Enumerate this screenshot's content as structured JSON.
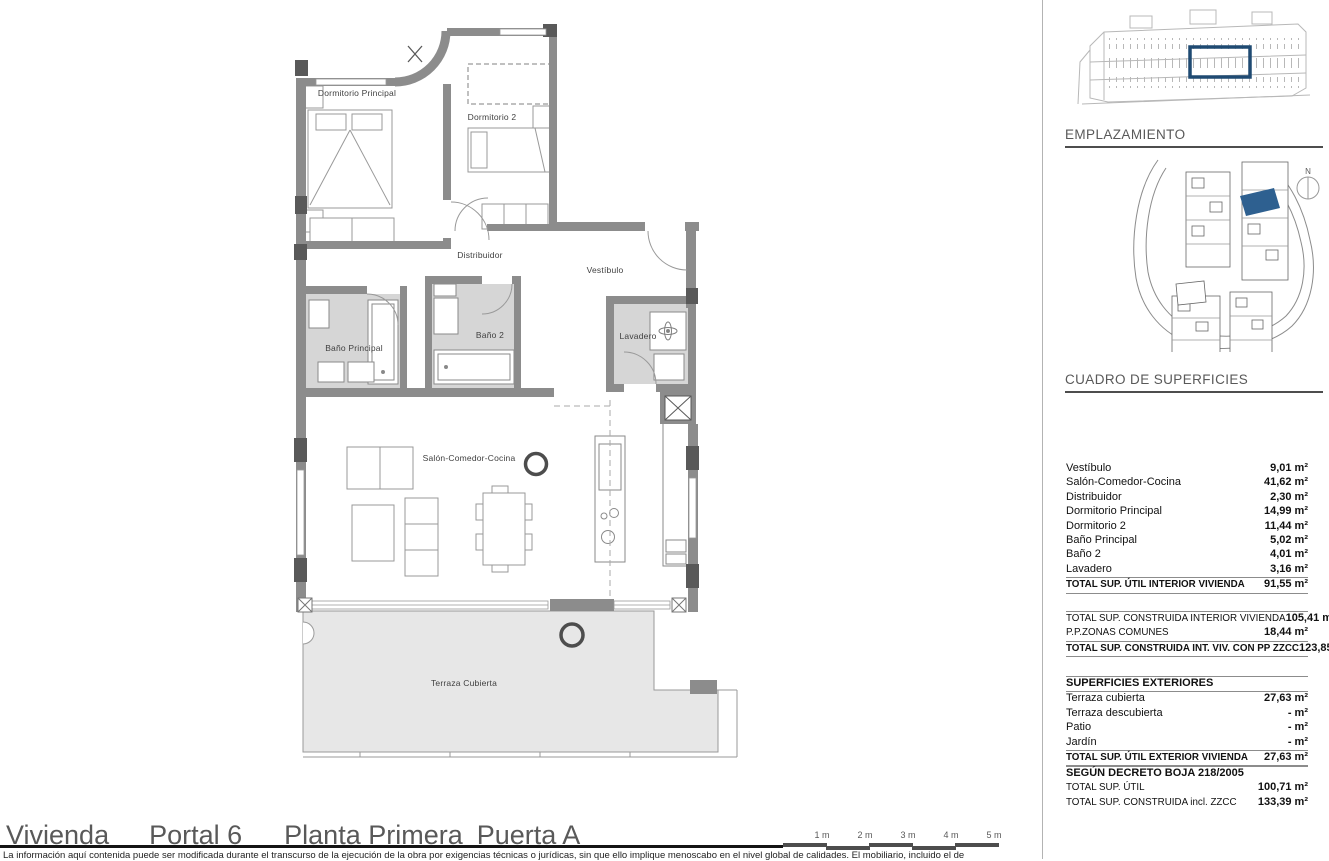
{
  "plan": {
    "room_labels": {
      "dormitorio_principal": "Dormitorio Principal",
      "dormitorio_2": "Dormitorio 2",
      "distribuidor": "Distribuidor",
      "vestibulo": "Vestíbulo",
      "bano_principal": "Baño Principal",
      "bano_2": "Baño 2",
      "lavadero": "Lavadero",
      "salon": "Salón-Comedor-Cocina",
      "terraza": "Terraza Cubierta"
    }
  },
  "sidebar": {
    "emplazamiento_heading": "EMPLAZAMIENTO",
    "north_label": "N",
    "cuadro_heading": "CUADRO DE SUPERFICIES",
    "interior": {
      "rows": [
        {
          "label": "Vestíbulo",
          "value": "9,01 m²"
        },
        {
          "label": "Salón-Comedor-Cocina",
          "value": "41,62 m²"
        },
        {
          "label": "Distribuidor",
          "value": "2,30 m²"
        },
        {
          "label": "Dormitorio Principal",
          "value": "14,99 m²"
        },
        {
          "label": "Dormitorio 2",
          "value": "11,44 m²"
        },
        {
          "label": "Baño Principal",
          "value": "5,02 m²"
        },
        {
          "label": "Baño 2",
          "value": "4,01 m²"
        },
        {
          "label": "Lavadero",
          "value": "3,16 m²"
        }
      ],
      "total": {
        "label": "TOTAL SUP. ÚTIL INTERIOR VIVIENDA",
        "value": "91,55 m²"
      }
    },
    "construida": {
      "rows": [
        {
          "label": "TOTAL SUP. CONSTRUIDA INTERIOR VIVIENDA",
          "value": "105,41 m²"
        },
        {
          "label": "P.P.ZONAS COMUNES",
          "value": "18,44 m²"
        }
      ],
      "total": {
        "label": "TOTAL SUP. CONSTRUIDA INT. VIV. CON PP ZZCC",
        "value": "123,85 m²"
      }
    },
    "exteriores": {
      "heading": "SUPERFICIES EXTERIORES",
      "rows": [
        {
          "label": "Terraza cubierta",
          "value": "27,63 m²"
        },
        {
          "label": "Terraza descubierta",
          "value": "- m²"
        },
        {
          "label": "Patio",
          "value": "- m²"
        },
        {
          "label": "Jardín",
          "value": "- m²"
        }
      ],
      "total": {
        "label": "TOTAL SUP. ÚTIL EXTERIOR VIVIENDA",
        "value": "27,63 m²"
      }
    },
    "decreto": {
      "heading": "SEGÚN DECRETO BOJA 218/2005",
      "rows": [
        {
          "label": "TOTAL SUP. ÚTIL",
          "value": "100,71 m²"
        },
        {
          "label": "TOTAL SUP. CONSTRUIDA incl. ZZCC",
          "value": "133,39 m²"
        }
      ]
    }
  },
  "footer": {
    "title_parts": [
      "Vivienda",
      "Portal 6",
      "Planta Primera",
      "Puerta A"
    ],
    "scale_labels": [
      "1 m",
      "2 m",
      "3 m",
      "4 m",
      "5 m"
    ],
    "disclaimer": "La información aquí contenida puede ser modificada durante el transcurso de la ejecución de la obra por exigencias técnicas o jurídicas, sin que ello implique menoscabo en el nivel global de calidades. El mobiliario, incluido el de"
  },
  "colors": {
    "highlight_blue": "#2e6090",
    "wall_gray": "#8c8c8c",
    "heading_gray": "#595959",
    "terrace_gray": "#e7e7e7",
    "bath_floor_gray": "#d6d6d6"
  }
}
